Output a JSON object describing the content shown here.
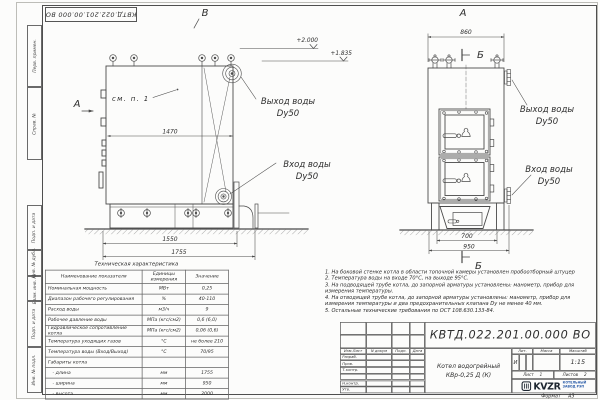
{
  "colors": {
    "line": "#4a4a4a",
    "text": "#2e2e2e",
    "logo_blue": "#2a5ca8",
    "paper": "#fcfcfb"
  },
  "stamp_top": {
    "doc_number": "КВТД.022.201.00.000 ВО"
  },
  "frame_column": [
    "Перв. примен.",
    "Справ. №",
    "Подп. и дата",
    "Инв. № дубл.",
    "Взам. инв. №",
    "Подп. и дата",
    "Инв. № подл."
  ],
  "views": {
    "left": {
      "view_label": "В",
      "dir_label": "А",
      "see_note": "см. п. 1",
      "dim_inner": "1470",
      "dim_base": "1550",
      "dim_overall": "1755",
      "outlet_label": "Выход воды",
      "outlet_dn": "Dy50",
      "inlet_label": "Вход воды",
      "inlet_dn": "Dy50"
    },
    "elevations": {
      "top": "+2.000",
      "mid": "+1.835"
    },
    "right": {
      "view_label": "А",
      "section_label_top": "Б",
      "section_label_bottom": "Б",
      "dim_top": "860",
      "dim_hopper": "700",
      "dim_overall": "950",
      "outlet_label": "Выход воды",
      "outlet_dn": "Dy50",
      "inlet_label": "Вход воды",
      "inlet_dn": "Dy50"
    }
  },
  "tech_table": {
    "title": "Техническая характеристика",
    "headers": [
      "Наименование показателя",
      "Единицы измерения",
      "Значение"
    ],
    "rows": [
      [
        "Номинальная мощность",
        "МВт",
        "0,25"
      ],
      [
        "Диапазон рабочего регулирования",
        "%",
        "40-110"
      ],
      [
        "Расход воды",
        "м3/ч",
        "9"
      ],
      [
        "Рабочее давление воды",
        "МПа (кгс/см2)",
        "0,6 (6,0)"
      ],
      [
        "Гидравлическое сопротивление котла",
        "МПа (кгс/см2)",
        "0,06 (0,6)"
      ],
      [
        "Температура уходящих газов",
        "°С",
        "не более 210"
      ],
      [
        "Температура воды (Вход/Выход)",
        "°С",
        "70/95"
      ],
      [
        "Габариты котла",
        "",
        ""
      ],
      [
        "- длина",
        "мм",
        "1755"
      ],
      [
        "- ширина",
        "мм",
        "950"
      ],
      [
        "- высота",
        "мм",
        "2000"
      ]
    ]
  },
  "notes": [
    "1. На боковой стенке котла в области топочной камеры установлен пробоотборный штуцер",
    "2. Температура воды на входе 70°С, на выходе 95°С.",
    "3. На подводящей трубе котла, до запорной арматуры установлены: манометр, прибор для измерения температуры.",
    "4. На отводящей трубе котла, до запорной арматуры установлены: манометр, прибор для измерения температуры и два предохранительных клапана Dу не менее 40 мм.",
    "5. Остальные технические требования по ОСТ 108.630.133-84."
  ],
  "title_block": {
    "doc_number": "КВТД.022.201.00.000 ВО",
    "col_headers": [
      "Изм.Лист",
      "N докум",
      "Подп.",
      "Дата"
    ],
    "row_labels": [
      "Разраб.",
      "Пров.",
      "Т.контр.",
      "",
      "Н.контр.",
      "Утв."
    ],
    "product_name_line1": "Котел водогрейный",
    "product_name_line2": "КВр-0,25 Д (К)",
    "lit_header": "Лит.",
    "mass_header": "Масса",
    "scale_header": "Масштаб",
    "lit_value": "И",
    "scale_value": "1:15",
    "sheet_label": "Лист",
    "sheet_value": "1",
    "sheets_label": "Листов",
    "sheets_value": "2",
    "logo_text": "KVZR",
    "logo_sub_line1": "КОТЕЛЬНЫЙ",
    "logo_sub_line2": "ЗАВОД РЭП"
  },
  "format_note": {
    "label": "Формат",
    "value": "А3"
  }
}
